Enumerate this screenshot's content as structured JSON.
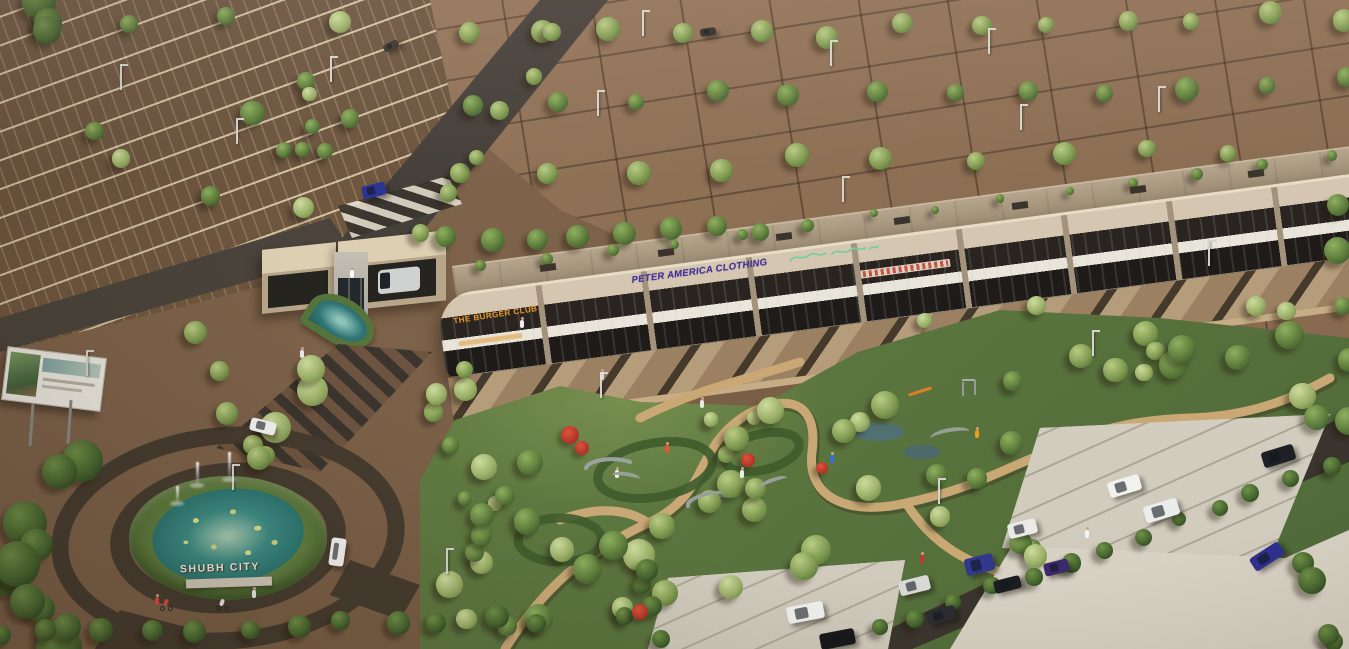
{
  "scene": {
    "title": "SHUBH CITY township — aerial 3D architectural render",
    "type": "3D visualization, bird's-eye view",
    "lighting": "warm late-afternoon sun from upper right, long shadows to lower left"
  },
  "monument": {
    "text": "SHUBH CITY",
    "color": "#f3efe4",
    "location": "hedge of fountain roundabout"
  },
  "building_signs": {
    "burger": {
      "text": "THE BURGER CLUB",
      "color": "#e2992f",
      "note_style": "orange block letters on curved end bay"
    },
    "burger_sub": {
      "text": "(illegible smaller orange line)",
      "color": "#e2992f"
    },
    "peter": {
      "text": "PETER AMERICA CLOTHING",
      "color": "#41309b",
      "note_style": "purple italic block letters"
    },
    "script_sign": {
      "text": "(illegible green cursive shop sign)",
      "color": "#6fcf9a"
    },
    "red_sign": {
      "text": "(illegible red shop sign)",
      "color": "#c23b2e"
    }
  },
  "entities": [
    "plotted land grid with trees and street lights (top)",
    "surface parking grid (top left)",
    "entrance gate with twin beige canopies, guard booth, teardrop water feature and zebra crossing",
    "two-storey commercial strip building with glass shopfronts, white canopies and rooftop plane",
    "striped entry boulevard",
    "fountain roundabout with lily pond, three water jets, SHUBH CITY letters, two cyclists and a white car",
    "advertising billboard on posts (left)",
    "central landscaped garden with winding tan paths, flower beds, pergola arcs and playground",
    "south-east access road with hedgerow",
    "parking bays with white, silver, black, blue and purple cars",
    "pedestrians walking in garden and plaza"
  ],
  "palette": {
    "earth": "#7d624a",
    "plot_field": "#8d6f55",
    "parking_asphalt": "#6b5540",
    "road_dark": "#3a352e",
    "stripe_brown": "#6d5440",
    "building_fascia": "#d4c6b0",
    "building_roof": "#b0a28b",
    "glass_dark": "#26211d",
    "canopy_white": "#e9e5da",
    "pond_teal": "#3c8d85",
    "foliage_mid": "#5d7c3b",
    "path_tan": "#c9a876",
    "pavement": "#d7d2c4",
    "monument_white": "#f3efe4"
  }
}
